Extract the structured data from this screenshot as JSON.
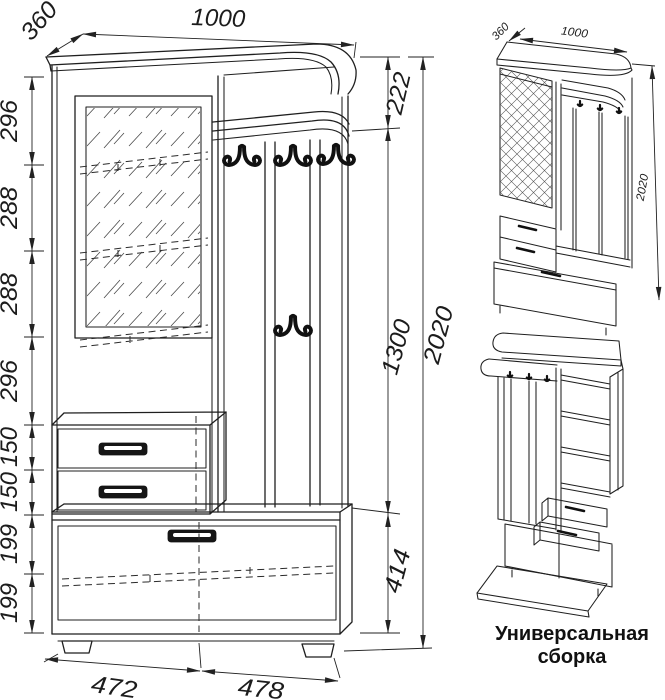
{
  "drawing_title": "hallway-unit-assembly-drawing",
  "colors": {
    "ink": "#1f1f1f",
    "background": "#ffffff"
  },
  "main_view": {
    "top_width": "1000",
    "top_depth": "360",
    "left_dims": [
      "296",
      "288",
      "288",
      "296",
      "150",
      "150",
      "199",
      "199"
    ],
    "right_dims": {
      "upper": "222",
      "middle": "1300",
      "lower": "414",
      "total": "2020"
    },
    "bottom_dims": [
      "472",
      "478"
    ]
  },
  "iso_view": {
    "depth": "360",
    "width": "1000",
    "height": "2020"
  },
  "caption": {
    "line1": "Универсальная",
    "line2": "сборка"
  }
}
